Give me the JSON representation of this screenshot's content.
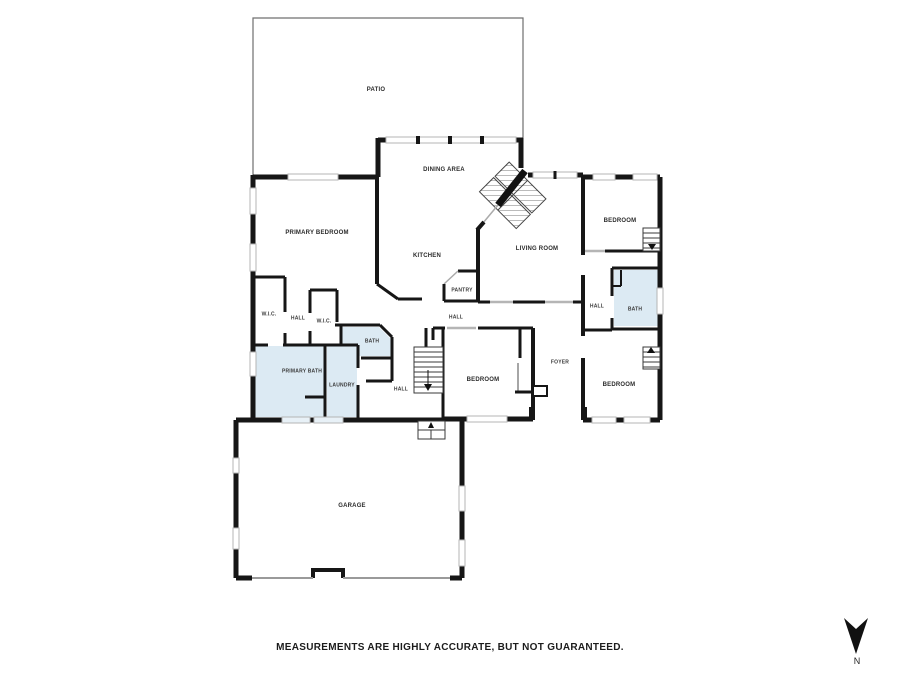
{
  "footer": {
    "disclaimer": "MEASUREMENTS ARE HIGHLY ACCURATE, BUT NOT GUARANTEED."
  },
  "compass": {
    "label": "N",
    "icon": "north-arrow-icon",
    "direction": "down"
  },
  "colors": {
    "wall": "#161616",
    "wet_room_fill": "#dceaf3",
    "window": "#b5b5b5",
    "background": "#ffffff"
  },
  "rooms": [
    {
      "label": "PATIO"
    },
    {
      "label": "DINING AREA"
    },
    {
      "label": "PRIMARY BEDROOM"
    },
    {
      "label": "KITCHEN"
    },
    {
      "label": "LIVING ROOM"
    },
    {
      "label": "BEDROOM"
    },
    {
      "label": "PANTRY"
    },
    {
      "label": "HALL"
    },
    {
      "label": "HALL"
    },
    {
      "label": "BATH"
    },
    {
      "label": "W.I.C."
    },
    {
      "label": "HALL"
    },
    {
      "label": "W.I.C."
    },
    {
      "label": "BATH"
    },
    {
      "label": "PRIMARY BATH"
    },
    {
      "label": "LAUNDRY"
    },
    {
      "label": "HALL"
    },
    {
      "label": "BEDROOM"
    },
    {
      "label": "FOYER"
    },
    {
      "label": "BEDROOM"
    },
    {
      "label": "GARAGE"
    }
  ]
}
